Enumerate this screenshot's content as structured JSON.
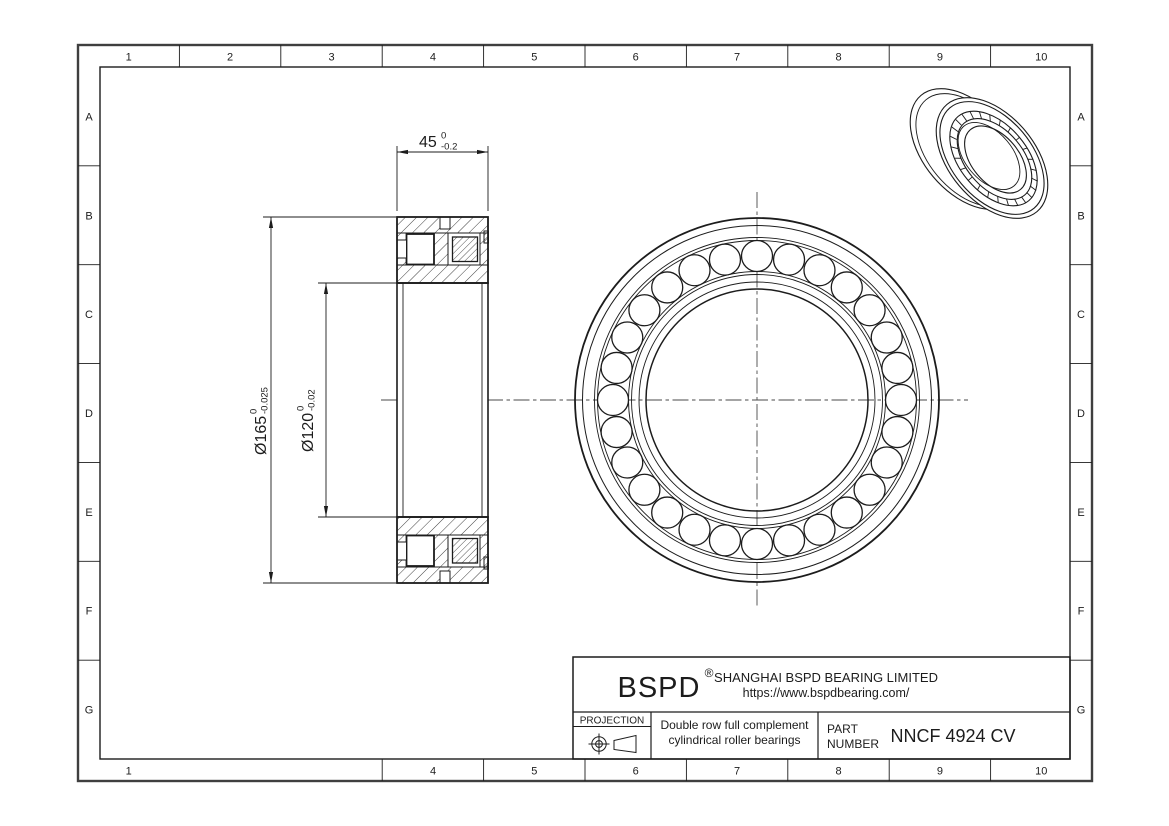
{
  "page": {
    "background": "#ffffff",
    "line_color": "#1c1c1c",
    "centerline_color": "#4a4a4a"
  },
  "border": {
    "top_labels": [
      "1",
      "2",
      "3",
      "4",
      "5",
      "6",
      "7",
      "8",
      "9",
      "10"
    ],
    "bottom_labels": [
      "1",
      "4",
      "5",
      "6",
      "7",
      "8",
      "9",
      "10"
    ],
    "left_labels": [
      "A",
      "B",
      "C",
      "D",
      "E",
      "F",
      "G"
    ],
    "right_labels": [
      "A",
      "B",
      "C",
      "D",
      "E",
      "F",
      "G"
    ]
  },
  "dimensions": {
    "width": {
      "value": "45",
      "tol_upper": "0",
      "tol_lower": "-0.2"
    },
    "outer_diameter": {
      "value": "Ø165",
      "tol_upper": "0",
      "tol_lower": "-0.025"
    },
    "bore_diameter": {
      "value": "Ø120",
      "tol_upper": "0",
      "tol_lower": "-0.02"
    }
  },
  "front_view": {
    "roller_count": 28
  },
  "iso_view": {
    "roller_tick_count": 26
  },
  "title_block": {
    "brand": "BSPD",
    "registered_mark": "®",
    "company": "SHANGHAI BSPD BEARING LIMITED",
    "website": "https://www.bspdbearing.com/",
    "projection_label": "PROJECTION",
    "description_line1": "Double row full complement",
    "description_line2": "cylindrical roller bearings",
    "part_label_line1": "PART",
    "part_label_line2": "NUMBER",
    "part_number": "NNCF 4924 CV"
  }
}
